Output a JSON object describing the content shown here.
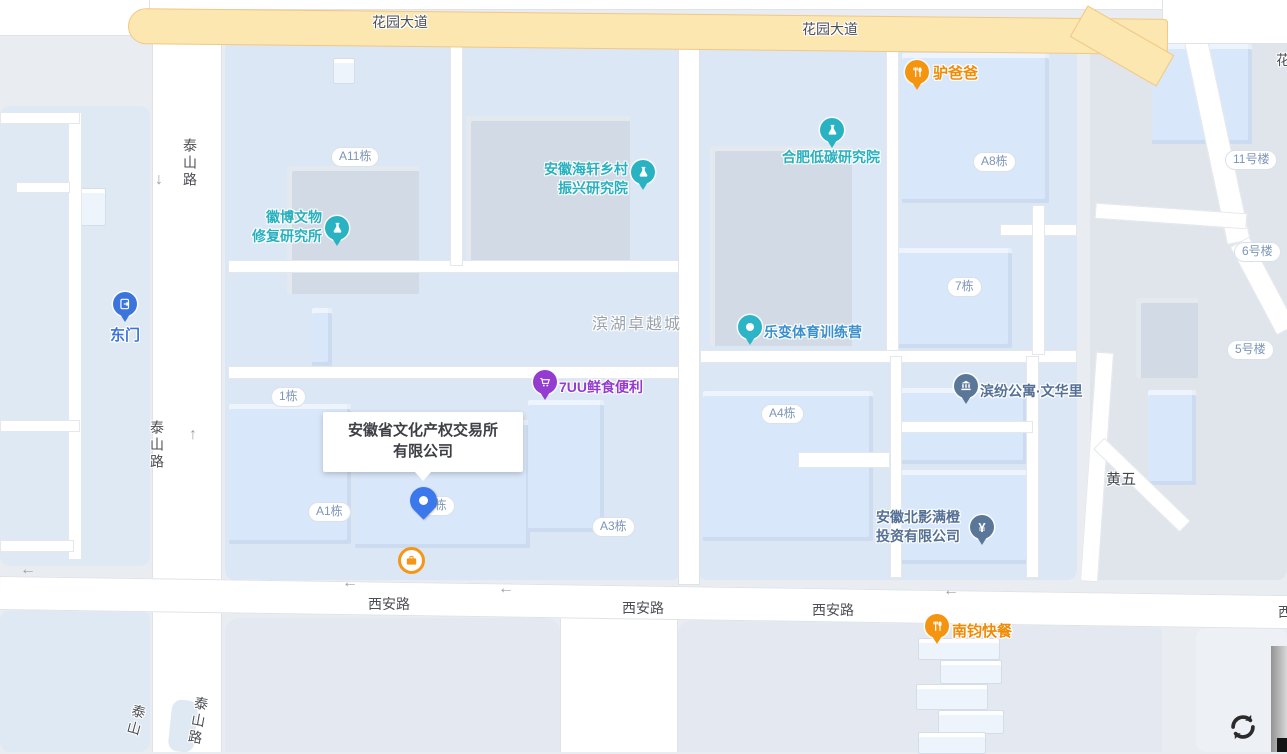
{
  "roads": {
    "huayuan": [
      "花园大道",
      "花园大道"
    ],
    "huayuan_partial": "花",
    "xian": [
      "西安路",
      "西安路",
      "西安路"
    ],
    "xian_partial": "西",
    "taishan_upper": "泰山路",
    "taishan_mid": "泰山路",
    "taishan_bottom_left": "泰山",
    "taishan_bottom_right": "泰山路",
    "huangwu": "黄五"
  },
  "areas": {
    "binhu": "滨湖卓越城"
  },
  "buildings": {
    "a11": "A11栋",
    "a8": "A8栋",
    "b7": "7栋",
    "no11": "11号楼",
    "no6": "6号楼",
    "no5": "5号楼",
    "b1": "1栋",
    "a1": "A1栋",
    "b2": "2栋",
    "a4": "A4栋",
    "a3": "A3栋"
  },
  "pois": {
    "lvbaba": {
      "label": "驴爸爸",
      "color": "#f5950f"
    },
    "ditan": {
      "label": "合肥低碳研究院",
      "color": "#29b2c2"
    },
    "haixuan": {
      "line1": "安徽海轩乡村",
      "line2": "振兴研究院",
      "color": "#29b2c2"
    },
    "huibo": {
      "line1": "徽博文物",
      "line2": "修复研究所",
      "color": "#29b2c2"
    },
    "dongmen": {
      "label": "东门",
      "color": "#3c74dd"
    },
    "lebian": {
      "label": "乐变体育训练营",
      "color": "#3a8fcd"
    },
    "qiuu": {
      "label": "7UU鲜食便利",
      "color": "#943bd0"
    },
    "binfen": {
      "label": "滨纷公寓·文华里",
      "color": "#547095"
    },
    "beiying": {
      "line1": "安徽北影满橙",
      "line2": "投资有限公司",
      "color": "#547095",
      "glyph": "¥"
    },
    "nanjun": {
      "label": "南钧快餐",
      "color": "#f5950f"
    }
  },
  "main_place": {
    "line1": "安徽省文化产权交易所",
    "line2": "有限公司"
  },
  "arrows": {
    "left": "←",
    "up": "↑",
    "down": "↓"
  },
  "colors": {
    "background": "#e9edf2",
    "highway_fill": "#fbe7af",
    "highway_border": "#f2c784",
    "road_fill": "#ffffff",
    "block_fill": "#dce7f5",
    "building_fill": "#d8e7fa",
    "building_gray": "#d2dae5",
    "pin_main": "#3b78ec",
    "road_label": "#4c4e55",
    "building_label": "#7d95b8",
    "area_label": "#9aa2ad"
  }
}
